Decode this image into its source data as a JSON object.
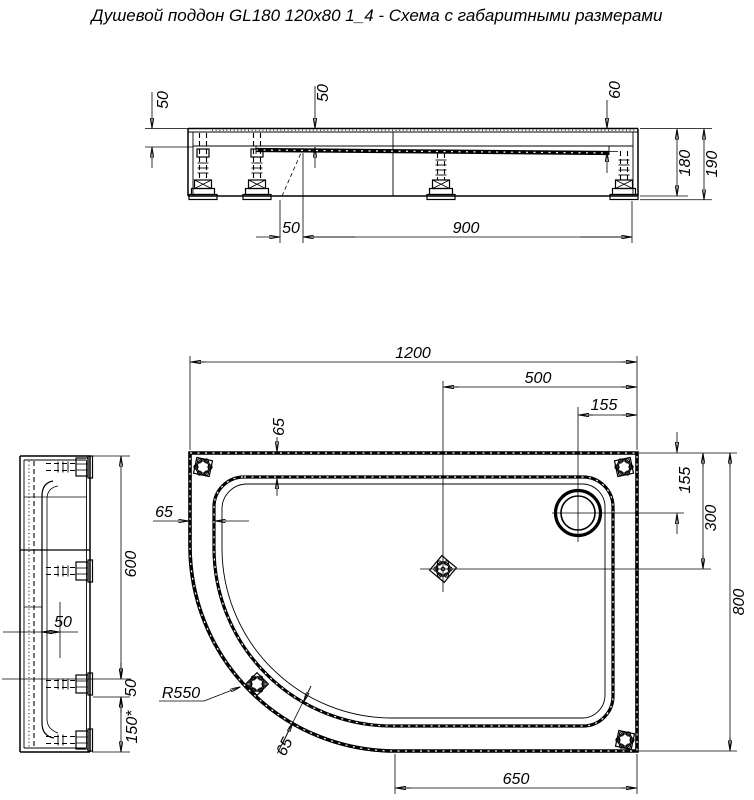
{
  "title": "Душевой поддон GL180 120x80 1_4 - Схема с габаритными размерами",
  "views": {
    "front": {
      "dims": {
        "depth_left": "50",
        "depth_mid": "50",
        "depth_right": "60",
        "body_height": "180",
        "total_height": "190",
        "foot_offset": "50",
        "foot_span": "900"
      }
    },
    "side": {
      "dims": {
        "length": "600",
        "inner_offset": "50",
        "foot_gap": "50",
        "edge_zone": "150*"
      }
    },
    "plan": {
      "dims": {
        "width": "1200",
        "drain_from_right": "500",
        "hole_from_right": "155",
        "rim_top": "65",
        "rim_left": "65",
        "hole_from_top": "155",
        "drain_from_top": "300",
        "depth": "800",
        "corner_radius": "R550",
        "rim_diagonal": "65",
        "bottom_flat": "650"
      }
    }
  }
}
